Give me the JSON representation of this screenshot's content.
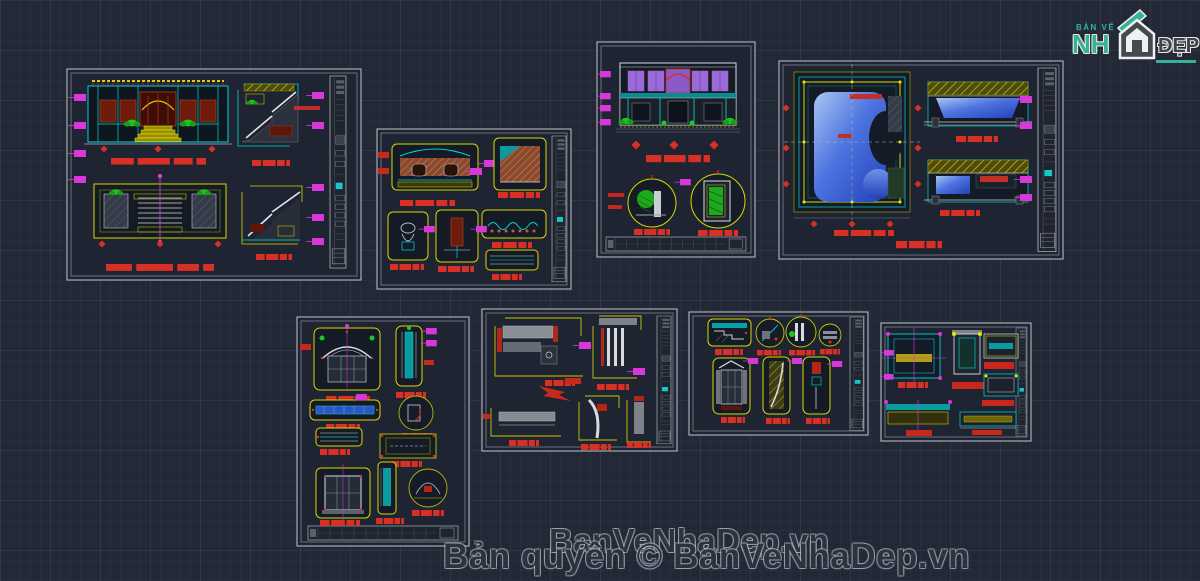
{
  "page": {
    "background_color": "#222836",
    "description": "Dark CAD model-space canvas with eight architectural drawing sheets"
  },
  "logo": {
    "line_top": "BẢN VẼ",
    "line_main": "NH",
    "line_right": "ĐẸP",
    "green": "#35b394",
    "gray": "#3e4347",
    "icon": "house-icon"
  },
  "watermark": {
    "line1": "BanVeNhaDep.vn",
    "line2": "Bản quyền © BanVeNhaDep.vn"
  },
  "palette": {
    "cad_cyan": "#00d4d4",
    "cad_yellow": "#e8e800",
    "cad_red": "#d93025",
    "cad_magenta": "#d838d8",
    "cad_green": "#1fc41f",
    "cad_maroon": "#6e1a0c",
    "pool_blue": "#4d74e0",
    "cad_white": "#d8dce2",
    "sheet_frame": "#c2c6cc"
  },
  "sheets": [
    {
      "id": "sheet-1",
      "content": "front elevation, floor plan and two stair sections"
    },
    {
      "id": "sheet-2",
      "content": "fireplace and fixture details"
    },
    {
      "id": "sheet-3",
      "content": "gate elevation with two circular details"
    },
    {
      "id": "sheet-4",
      "content": "swimming pool plan and two pool sections"
    },
    {
      "id": "sheet-5",
      "content": "arched window and frame details"
    },
    {
      "id": "sheet-6",
      "content": "cornice and molding details"
    },
    {
      "id": "sheet-7",
      "content": "window elevation and circular moulding details"
    },
    {
      "id": "sheet-8",
      "content": "small joinery details"
    }
  ]
}
